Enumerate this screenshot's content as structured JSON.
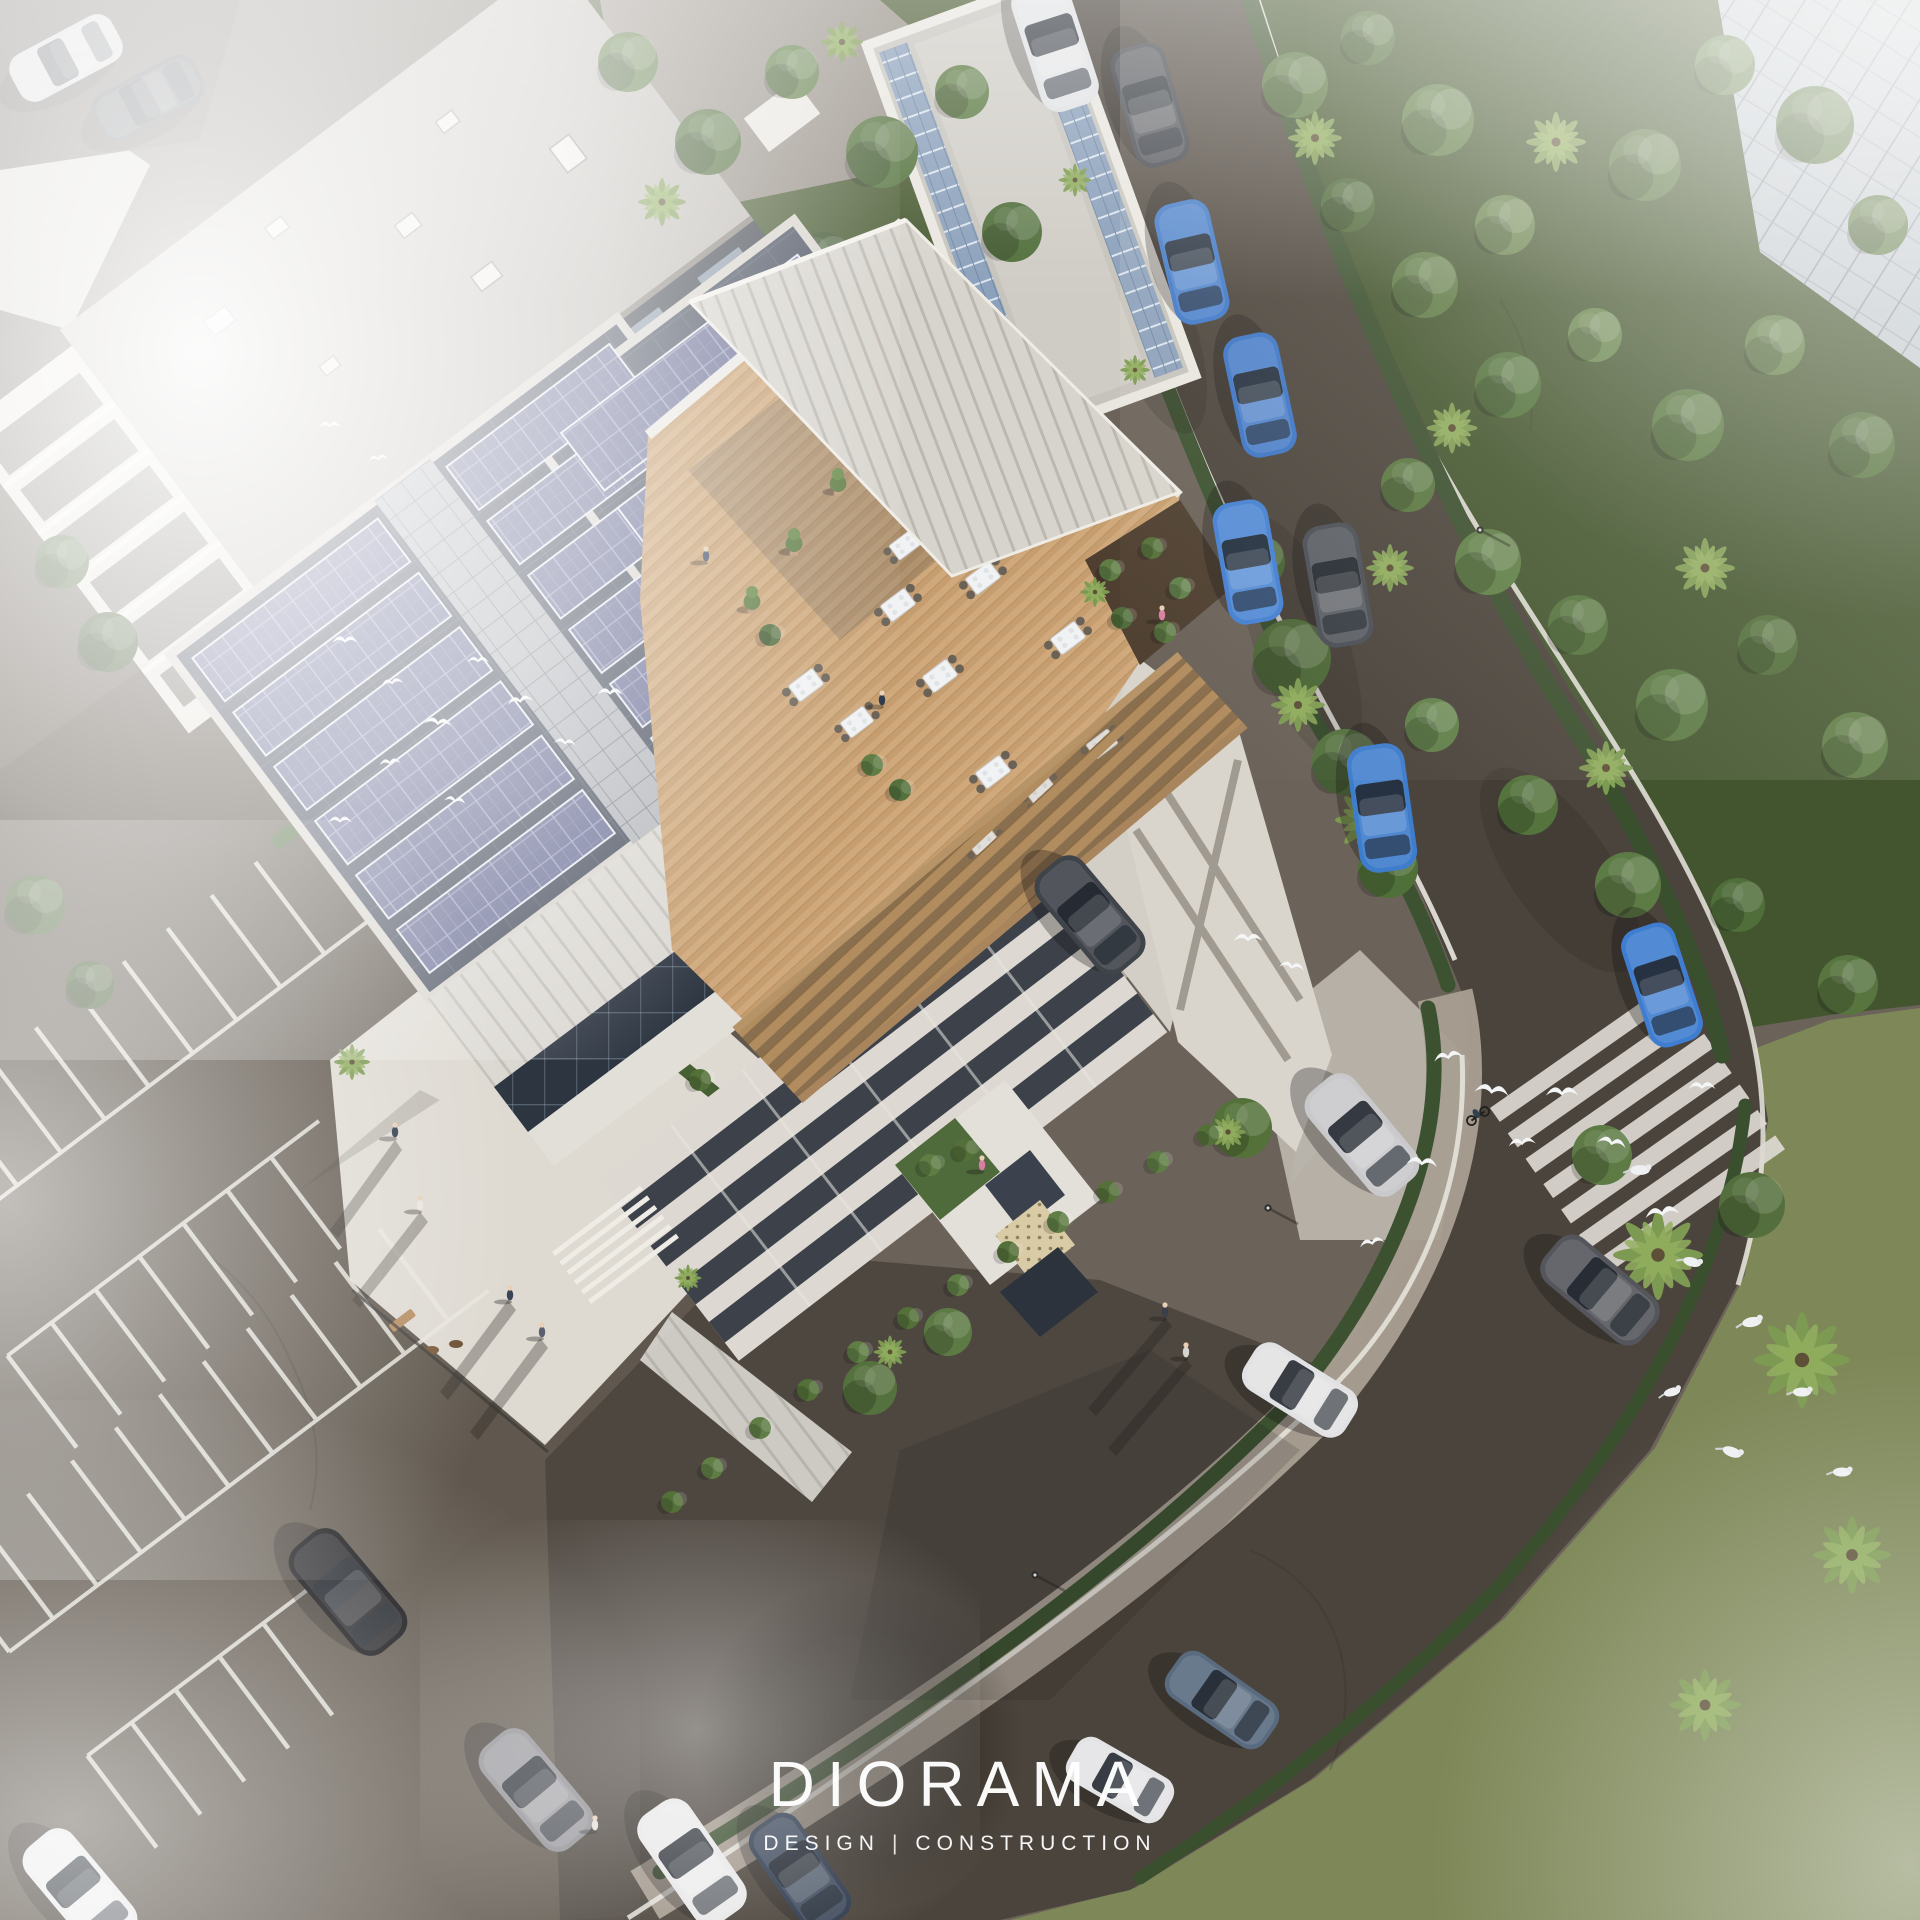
{
  "watermark": {
    "brand": "DIORAMA",
    "tagline_left": "DESIGN",
    "separator": "|",
    "tagline_right": "CONSTRUCTION"
  },
  "palette": {
    "asphalt_road": "#4b443c",
    "asphalt_parking": "#60584e",
    "concrete_plaza": "#dedad2",
    "white_architecture": "#e9e6df",
    "roof_deck": "#4a5160",
    "solar_panel": "#6e7298",
    "wood_terrace": "#c9a173",
    "pergola_wood": "#b18c5f",
    "canopy_roof": "#d7d4cd",
    "foliage_green": "#5a7742",
    "palm_green": "#7d9a52",
    "grass_green": "#7d8757",
    "road_marking": "#eae7e0",
    "car_blue": "#3e78c8",
    "fog_white": "#ffffff"
  }
}
